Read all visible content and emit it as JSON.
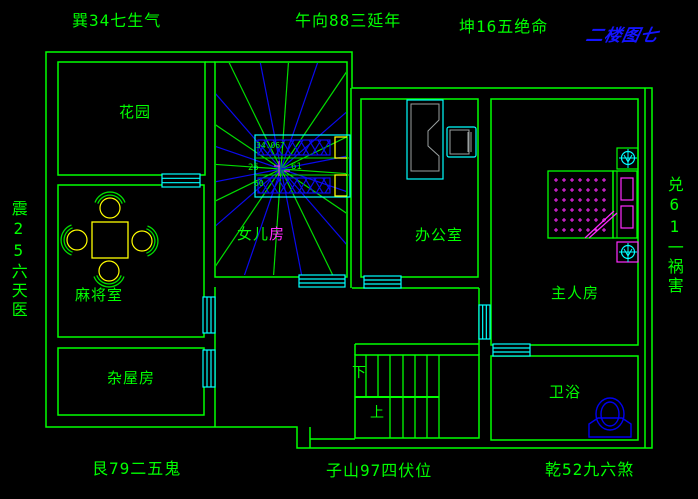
{
  "drawing": {
    "type": "floor-plan",
    "sheet_title": "二楼图七",
    "background": "#000000"
  },
  "annotations": {
    "top_left": "巽34七生气",
    "top_center": "午向88三延年",
    "top_right": "坤16五绝命",
    "left_vertical": "震25六天医",
    "right_vertical": "兑61一祸害",
    "bottom_left": "艮79二五鬼",
    "bottom_center": "子山97四伏位",
    "bottom_right": "乾52九六煞"
  },
  "rooms": {
    "garden": "花园",
    "mahjong": "麻将室",
    "storage": "杂屋房",
    "daughter_prefix": "女儿",
    "daughter_suffix": "房",
    "office": "办公室",
    "master": "主人房",
    "bath": "卫浴",
    "stairs_down": "下",
    "stairs_up": "上"
  },
  "compass": {
    "readings": {
      "top": "34.067",
      "left": "25",
      "right": "61",
      "bottom": "50"
    }
  },
  "colors": {
    "wall": "#00ff00",
    "window": "#00ffff",
    "ray_green": "#00dd00",
    "ray_blue": "#0a0aee",
    "furniture_yellow": "#ffff00",
    "accent_magenta": "#ff2bff",
    "toilet_blue": "#0000f0",
    "desk_gray": "#9aa0a0",
    "title_blue": "#1414ff"
  }
}
